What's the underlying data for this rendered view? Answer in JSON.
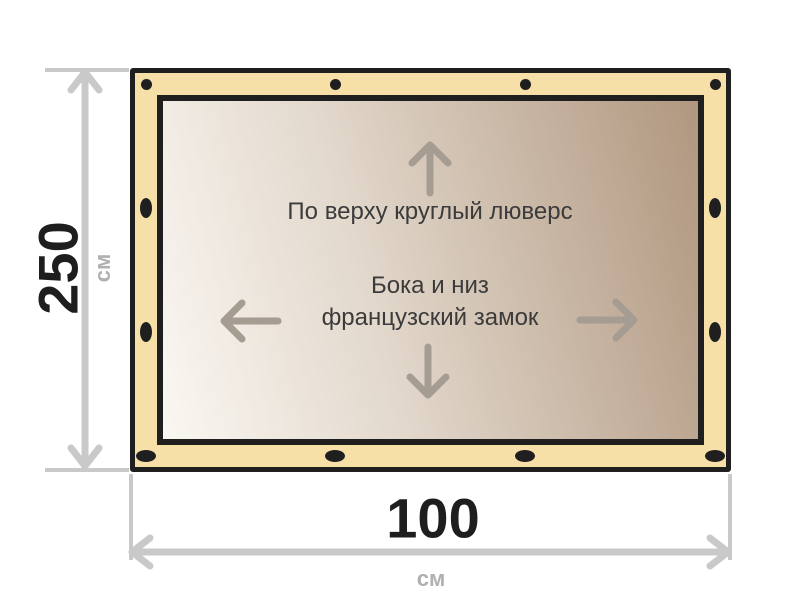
{
  "banner": {
    "annotations": {
      "top_note": "По верху круглый люверс",
      "middle_note_line1": "Бока и низ",
      "middle_note_line2": "французский замок"
    },
    "grommets": {
      "top_shape": "round",
      "side_shape": "vertical-oval",
      "bottom_shape": "horizontal-oval",
      "top_count": 4,
      "bottom_count": 4,
      "per_side_count": 2
    },
    "colors": {
      "edge_band": "#f6e0a8",
      "border": "#1f1f1f",
      "canvas_gradient_light": "#faf7f2",
      "canvas_gradient_dark": "#b0977f",
      "inner_arrow": "#a59c92",
      "note_text": "#3b3b3b"
    }
  },
  "dimensions": {
    "height": {
      "value": "250",
      "unit": "см"
    },
    "width": {
      "value": "100",
      "unit": "см"
    },
    "colors": {
      "arrow": "#c9c9c9",
      "value_text": "#1e1e1e",
      "unit_text": "#b0b0b0"
    }
  }
}
